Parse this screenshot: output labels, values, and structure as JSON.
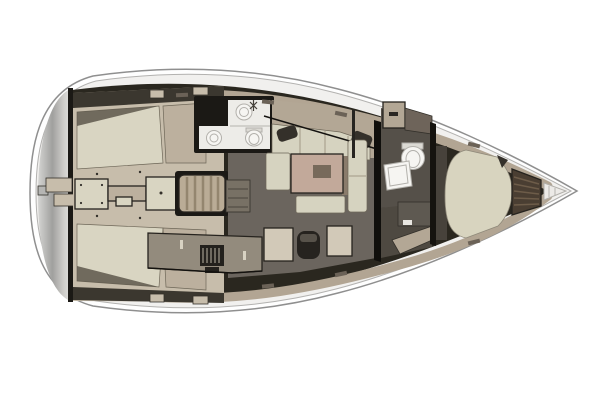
{
  "figure": {
    "type": "yacht-interior-floor-plan",
    "view": "top-down",
    "orientation": "bow-right-stern-left"
  },
  "palette": {
    "background": "#ffffff",
    "hull_white": "#fefefe",
    "deck_offwhite": "#f1f0ee",
    "interior_dark": "#2a271f",
    "lining_tan": "#b2a593",
    "wall_dark": "#1b1915",
    "transom_stop_a": "#d5d5d3",
    "transom_stop_b": "#a0a09e",
    "transom_stop_c": "#cecdc9",
    "transom_stop_d": "#e0dfdc",
    "step_gray": "#b5b5b3",
    "cockpit_beige": "#c7bdab",
    "bench_light": "#d9d5c2",
    "bench_tan": "#bcb09e",
    "coaming_dark": "#3b372f",
    "hatch_tan": "#baac96",
    "floor_gray": "#6b655e",
    "steps_gray": "#787165",
    "hatch_floor": "#5f5a52",
    "room_white": "#edece8",
    "fixture_white": "#f6f5f2",
    "tank_gray": "#dcdad4",
    "settee_tan": "#b3a795",
    "cushion_light": "#d6d3c0",
    "table_tan": "#c2a99a",
    "table_inlay": "#776a5b",
    "table_shadow": "#8a7b6b",
    "dark_item": "#34302a",
    "column_dark": "#262420",
    "galley_counter": "#938b7d",
    "stove_dark": "#23211d",
    "counter_mark": "#d8d2c2",
    "chart_table": "#d2c9b8",
    "seat_dark": "#26231f",
    "seat_back": "#57524a",
    "head_floor": "#555049",
    "passage_floor": "#4e4941",
    "cabin_floor": "#47423b",
    "locker_brown_cab": "#6e645a",
    "mattress_beige": "#d8d4bf",
    "pillow_shadow": "#35312b",
    "shelf_gray": "#5e5951",
    "shelf_handle": "#e8e6e1",
    "locker_brown": "#4a3e32",
    "bow_white": "#eceae7",
    "handle_dark": "#2a2723"
  },
  "zones": [
    {
      "id": "swim-platform",
      "label": "stern swim platform / transom"
    },
    {
      "id": "cockpit",
      "label": "cockpit with centerline table and side benches"
    },
    {
      "id": "companionway-hatch",
      "label": "ribbed sliding companionway hatch"
    },
    {
      "id": "aft-head",
      "label": "aft bathroom with sink, basin and toilet"
    },
    {
      "id": "salon",
      "label": "main salon with dinette table and settees"
    },
    {
      "id": "galley",
      "label": "port galley with stove"
    },
    {
      "id": "nav-station",
      "label": "chart table with navigator seat"
    },
    {
      "id": "forward-head",
      "label": "forward bathroom with toilet and shower"
    },
    {
      "id": "forward-cabin",
      "label": "forward V-berth cabin"
    },
    {
      "id": "anchor-locker",
      "label": "slatted bow locker"
    },
    {
      "id": "bow-tip",
      "label": "bow tip with anchor fitting"
    }
  ]
}
